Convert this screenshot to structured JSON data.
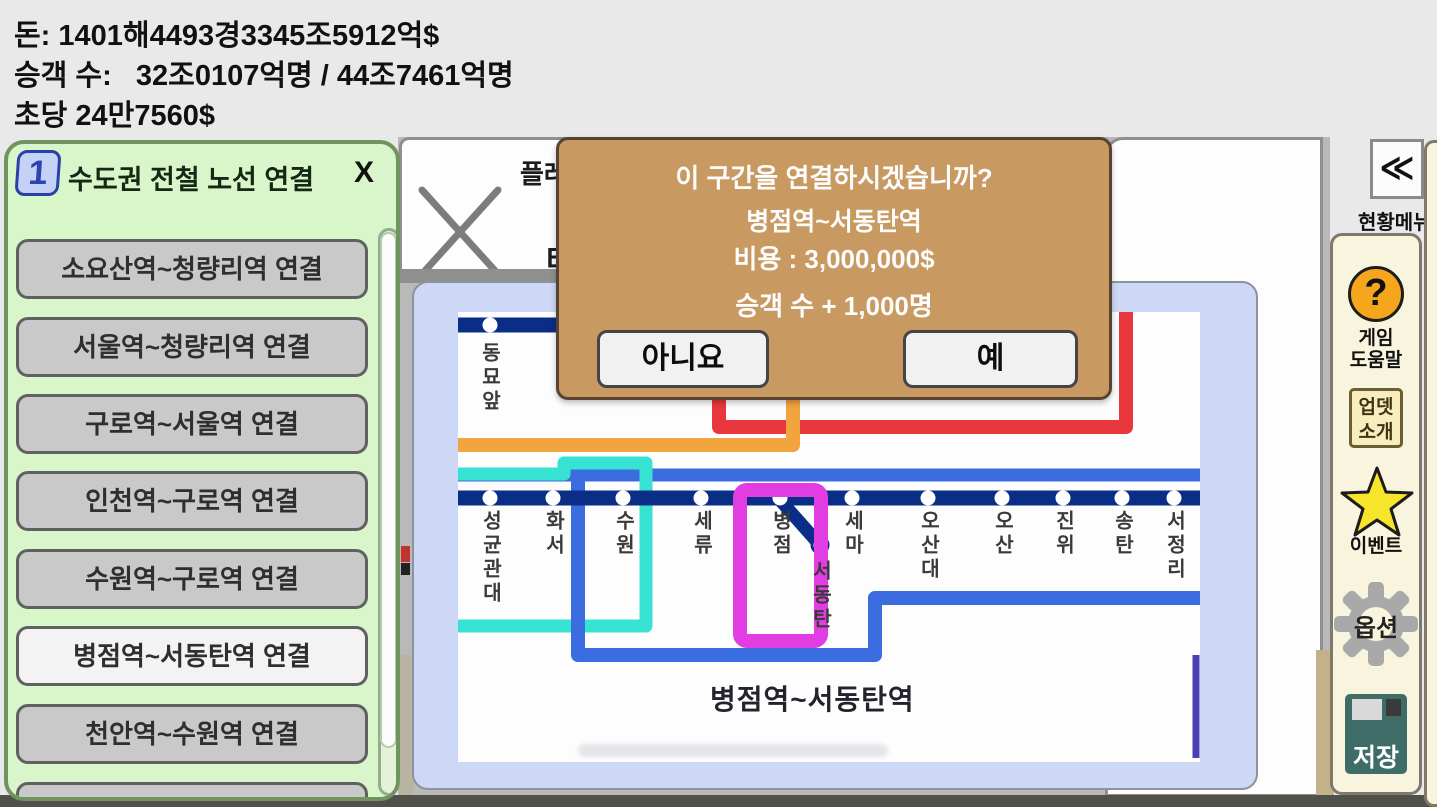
{
  "status_bar": {
    "money": "돈: 1401해4493경3345조5912억$",
    "passengers": "승객 수:   32조0107억명 / 44조7461억명",
    "per_second": "초당 24만7560$"
  },
  "backdrop": {
    "play_partial": "플레",
    "tunnel_partial": "터"
  },
  "line_panel": {
    "badge": "1",
    "title": "수도권 전철 노선 연결",
    "close_label": "X",
    "buttons": [
      {
        "label": "소요산역~청량리역 연결",
        "highlighted": false
      },
      {
        "label": "서울역~청량리역 연결",
        "highlighted": false
      },
      {
        "label": "구로역~서울역 연결",
        "highlighted": false
      },
      {
        "label": "인천역~구로역 연결",
        "highlighted": false
      },
      {
        "label": "수원역~구로역 연결",
        "highlighted": false
      },
      {
        "label": "병점역~서동탄역 연결",
        "highlighted": true
      },
      {
        "label": "천안역~수원역 연결",
        "highlighted": false
      },
      {
        "label": "",
        "highlighted": false
      }
    ]
  },
  "dialog": {
    "question": "이 구간을 연결하시겠습니까?",
    "section": "병점역~서동탄역",
    "cost": "비용 : 3,000,000$",
    "passenger_bonus": "승객 수 + 1,000명",
    "no_label": "아니요",
    "yes_label": "예"
  },
  "map": {
    "top_station": "동묘앞",
    "covered_labels": [
      "동",
      "동",
      "리",
      "앞",
      "문"
    ],
    "stations": [
      "성균관대",
      "화서",
      "수원",
      "세류",
      "병점",
      "세마",
      "오산대",
      "오산",
      "진위",
      "송탄",
      "서정리"
    ],
    "branch_station": "서동탄",
    "section_label": "병점역~서동탄역"
  },
  "colors": {
    "line_navy": "#0a2d85",
    "line_blue": "#3b6ce0",
    "line_cyan": "#36e2d2",
    "line_red": "#e8383d",
    "line_orange": "#f2a43e",
    "line_magenta": "#e23de2",
    "line_indigo": "#4a3fb5",
    "dialog_bg": "#c89a62",
    "panel_green": "#d8f6c9",
    "sidebar_cream": "#f9f4de"
  },
  "sidebar": {
    "collapse": "≪",
    "menu_title": "현황메뉴",
    "help": {
      "glyph": "?",
      "line1": "게임",
      "line2": "도움말"
    },
    "update": {
      "line1": "업뎃",
      "line2": "소개"
    },
    "event": {
      "label": "이벤트"
    },
    "options": {
      "label": "옵션"
    },
    "save": {
      "label": "저장"
    }
  }
}
